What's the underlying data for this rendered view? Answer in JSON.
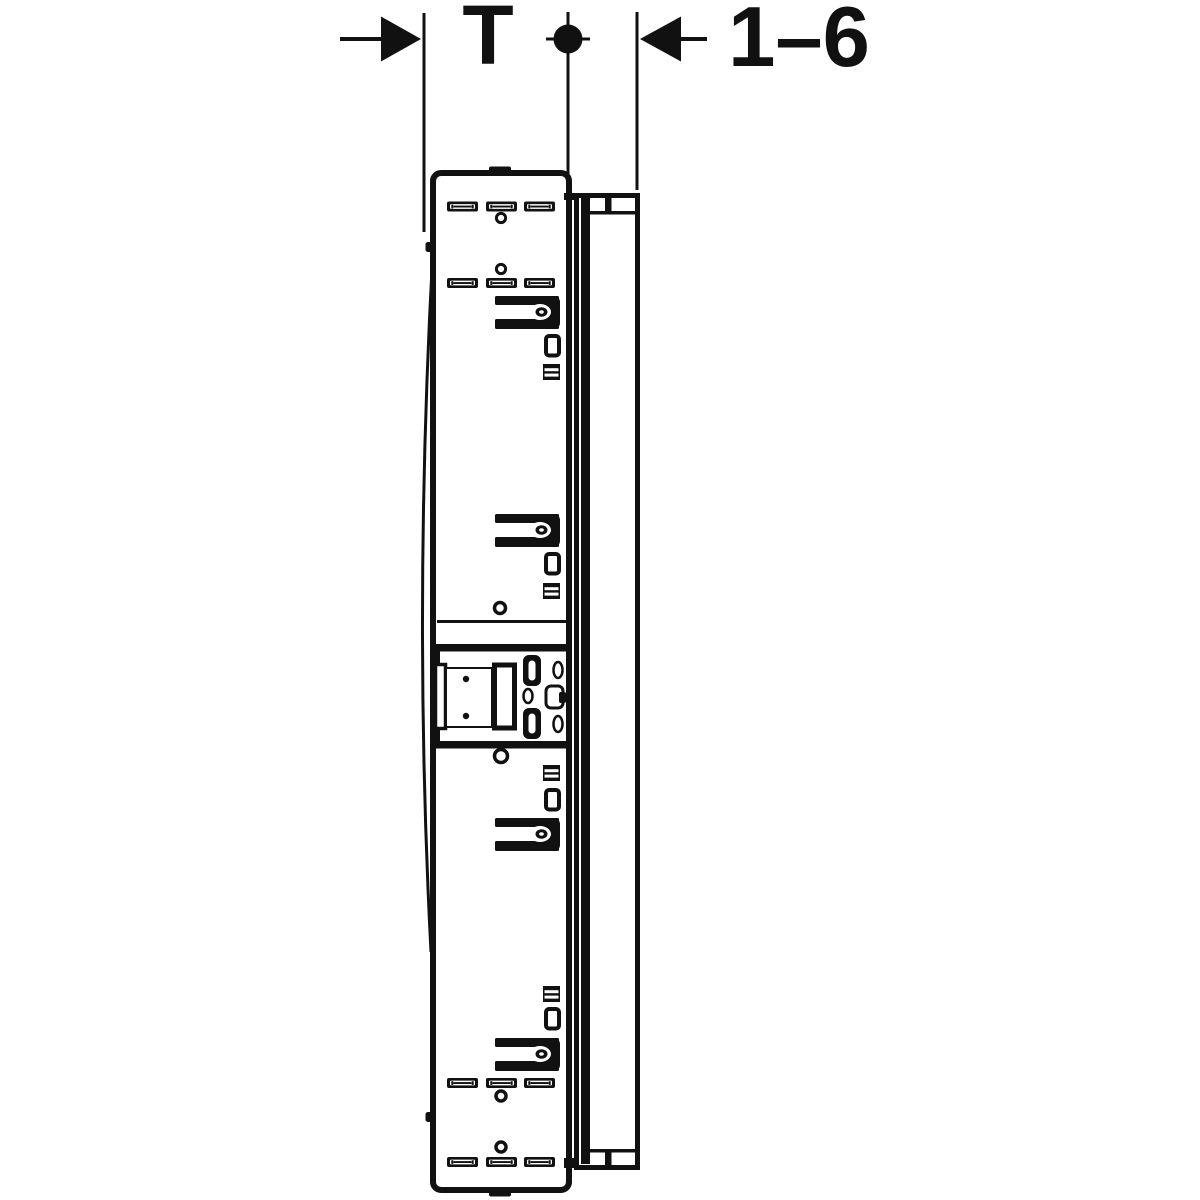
{
  "diagram": {
    "labels": {
      "depth": "T",
      "adjustment_range": "1–6"
    }
  },
  "icons": {
    "left_arrow": "dimension-arrow-right-icon",
    "right_arrow": "dimension-arrow-left-icon",
    "datum": "datum-dot-icon"
  },
  "colors": {
    "line": "#111111",
    "background": "#ffffff"
  }
}
